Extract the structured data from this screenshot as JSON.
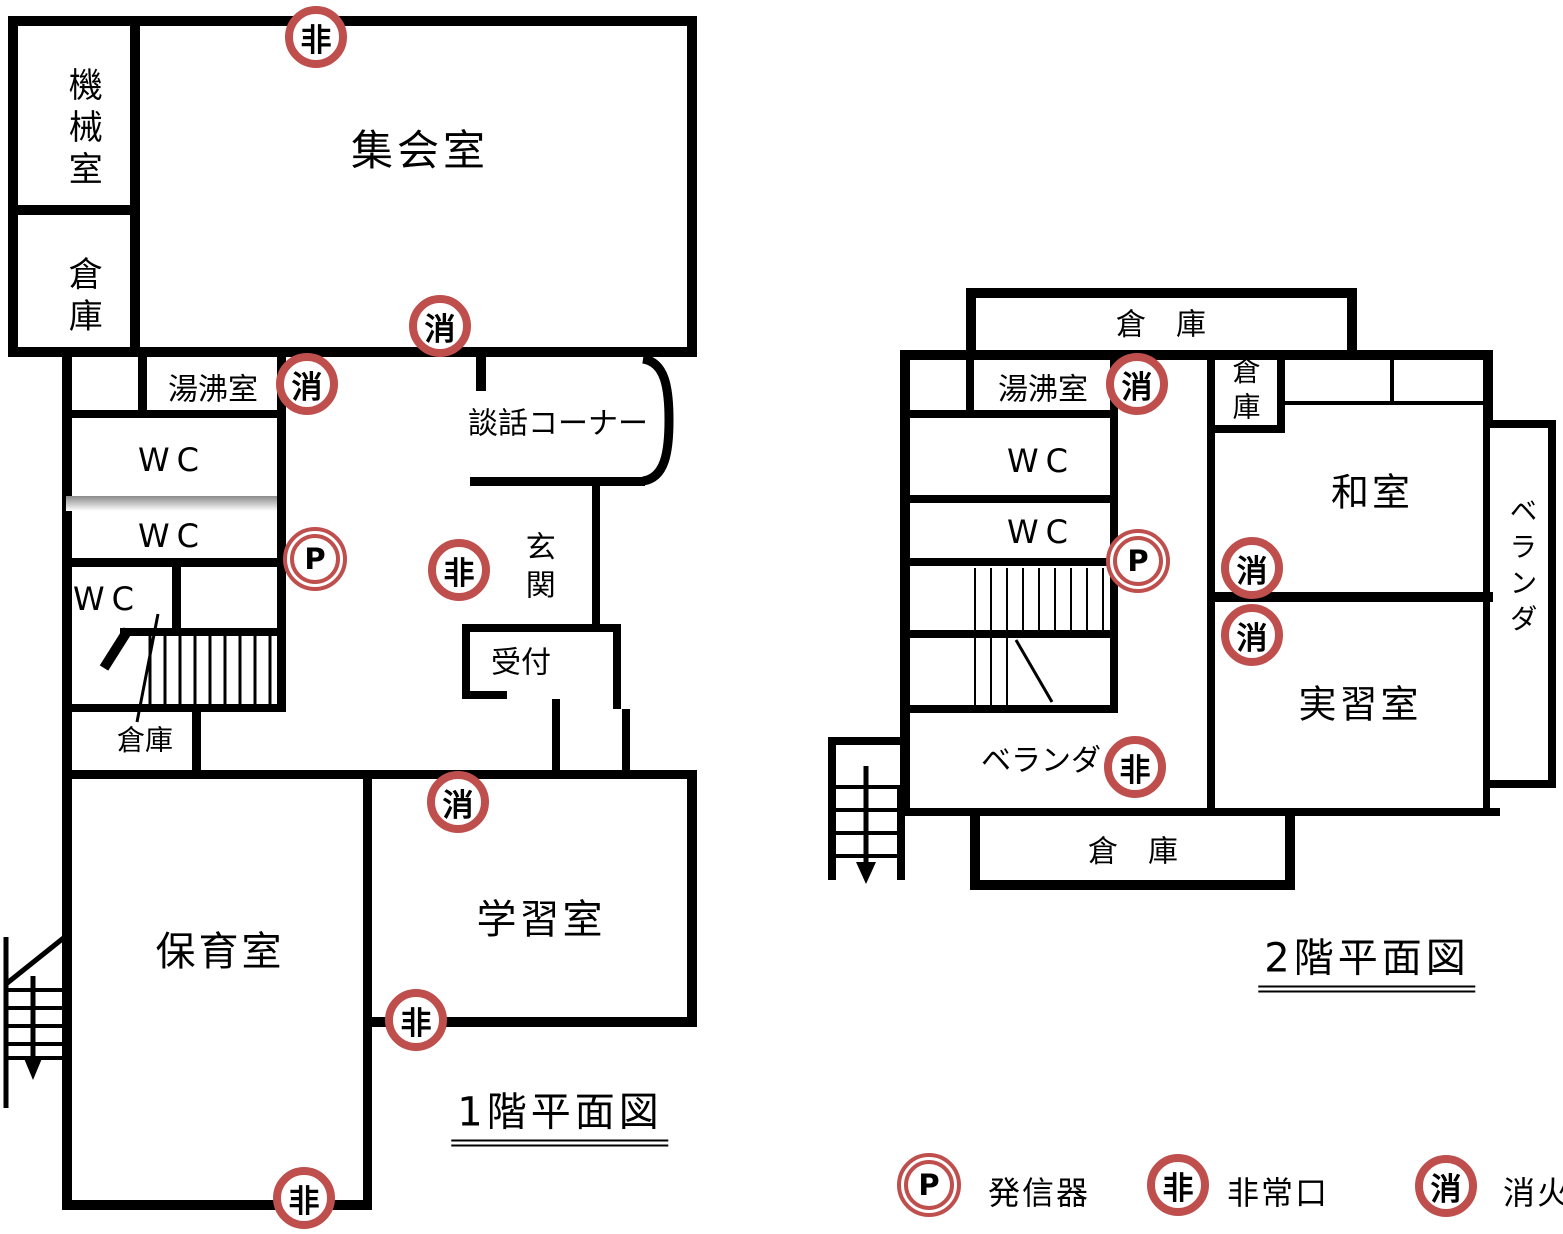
{
  "floor1": {
    "title": "1階平面図",
    "rooms": {
      "machine_room": "機械室",
      "storage_nw": "倉庫",
      "assembly_room": "集会室",
      "kettle_room": "湯沸室",
      "chat_corner": "談話コーナー",
      "wc_upper": "WC",
      "wc_middle": "WC",
      "wc_lower": "WC",
      "entrance": "玄関",
      "reception": "受付",
      "storage_mid": "倉庫",
      "nursery_room": "保育室",
      "study_room": "学習室"
    },
    "markers": [
      {
        "type": "emergency-exit",
        "glyph": "非"
      },
      {
        "type": "fire-extinguisher",
        "glyph": "消"
      },
      {
        "type": "fire-extinguisher",
        "glyph": "消"
      },
      {
        "type": "transmitter",
        "glyph": "P"
      },
      {
        "type": "emergency-exit",
        "glyph": "非"
      },
      {
        "type": "fire-extinguisher",
        "glyph": "消"
      },
      {
        "type": "emergency-exit",
        "glyph": "非"
      },
      {
        "type": "emergency-exit",
        "glyph": "非"
      }
    ]
  },
  "floor2": {
    "title": "2階平面図",
    "rooms": {
      "storage_top": "倉　庫",
      "kettle_room": "湯沸室",
      "wc_upper": "WC",
      "wc_lower": "WC",
      "storage_small": "倉庫",
      "japanese_room": "和室",
      "veranda_right": "ベランダ",
      "veranda_bottom": "ベランダ",
      "training_room": "実習室",
      "storage_bottom": "倉　庫"
    },
    "markers": [
      {
        "type": "fire-extinguisher",
        "glyph": "消"
      },
      {
        "type": "transmitter",
        "glyph": "P"
      },
      {
        "type": "fire-extinguisher",
        "glyph": "消"
      },
      {
        "type": "fire-extinguisher",
        "glyph": "消"
      },
      {
        "type": "emergency-exit",
        "glyph": "非"
      }
    ]
  },
  "legend": {
    "items": [
      {
        "glyph": "P",
        "label": "発信器"
      },
      {
        "glyph": "非",
        "label": "非常口"
      },
      {
        "glyph": "消",
        "label": "消火器"
      }
    ]
  }
}
